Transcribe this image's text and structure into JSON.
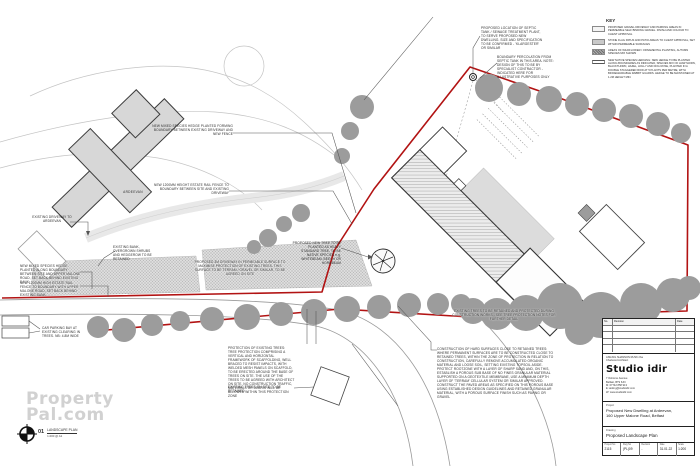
{
  "colors": {
    "boundary_red": "#b21313",
    "tree_gray": "#9c9c9c",
    "building_fill": "#d7d7d7"
  },
  "key": {
    "title": "KEY",
    "items": [
      {
        "icon": "gravel-swatch",
        "label": "PROPOSED GRAVEL DRIVEWAY AND PARKING AREAS IN PERMEABLE SELF BINDING GRAVEL. FINISH AND COLOUR TO CLIENT APPROVAL"
      },
      {
        "icon": "stone-flags-swatch",
        "label": "STONE FLAG PATHS AND PATIO AREAS TO CLIENT APPROVAL, SET WITHIN PERMEABLE SURFACES"
      },
      {
        "icon": "ornamental-planting-swatch",
        "label": "AREAS OF WILDFLOWER / ORNAMENTAL PLANTING, AUTUMN SPECIES MIX SHOWN"
      },
      {
        "icon": "hedge-swatch",
        "label": "NEW NATIVE SPECIES HEDGING: NEW HEDGE TO BE PLANTED ALONG BOUNDARIES AS INDICATED, SPECIES MIX OF HAWTHORN, BLACKTHORN, HAZEL, HOLLY AND DOG ROSE, PLANTED IN A DOUBLE STAGGERED ROW AT 5 PLANTS PER METRE, WITH BIODEGRADABLE RABBIT GUARDS. HEDGE TO BE MAINTAINED AT 1.2M HEIGHT MIN."
      }
    ]
  },
  "annotations": {
    "hedge_driveway": "NEW MIXED SPECIES HEDGE PLANTED FORMING BOUNDARY BETWEEN EXISTING DRIVEWAY AND NEW FENCE",
    "fence_driveway": "NEW 1200MM HEIGHT ESTATE RAIL FENCE TO BOUNDARY BETWEEN SITE AND EXISTING DRIVEWAY",
    "septic_tank": "PROPOSED LOCATION OF SEPTIC TANK / SEWAGE TREATMENT PLANT, TO SERVE PROPOSED NEW DWELLING. SIZE AND SPECIFICATION TO BE CONFIRMED - 'KLARGESTER' OR SIMILAR",
    "percolation": "BOUNDARY PERCOLATION FROM SEPTIC TANK IN THIS AREA. NOTE: DESIGN OF THIS TO BE BY SPECIALIST CONTRACTOR - INDICATED HERE FOR ILLUSTRATIVE PURPOSES ONLY",
    "existing_driveway": "EXISTING DRIVEWAY TO ARDEEVAN",
    "existing_bank": "EXISTING BANK, OVERGROWN SHRUBS AND HEDGEROW TO BE RETAINED",
    "hedge_road": "NEW MIXED SPECIES HEDGE PLANTED ALONG BOUNDARY BETWEEN SITE AND UPPER MALONE ROAD, SET BACK BEHIND EXISTING BANK",
    "fence_road": "NEW 1200MM HIGH ESTATE RAIL FENCE TO BOUNDARY WITH UPPER MALONE ROAD, SET BACK BEHIND EXISTING BANK",
    "car_parking": "CAR PARKING BAY AT EXISTING CLEARING IN TREES. NB: 4.8M WIDE",
    "new_driveway": "PROPOSED 3M DRIVEWAY IN PERMEABLE SURFACE TO MAXIMISE PROTECTION OF EXISTING TREES. THIS SURFACE TO BE TERRAM / GRAVEL OR SIMILAR, TO BE AGREED ON SITE",
    "new_tree": "PROPOSED NEW TREE TO BE PLANTED AS HEAVY STANDARD TREE, TO BE NATIVE SPECIES e.g. WHITEBEAM, BEECH OR HORNBEAM",
    "tree_protection": "PROTECTION OF EXISTING TREES: TREE PROTECTION COMPRISING A VERTICAL AND HORIZONTAL FRAMEWORK OF SCAFFOLDING, WELL BRACED TO RESIST IMPACTS, WITH WELDED MESH PANELS ON SCAFFOLD, TO BE ERECTED AROUND THE BASE OF TREES ON SITE. THE USE OF THE TREES TO BE AGREED WITH ARCHITECT ON SITE. NO CONSTRUCTION TRAFFIC, MATERIALS OR DEBRIS WILL BE ALLOWED WITHIN THIS PROTECTION ZONE",
    "trees_retained": "EXISTING TREES ON SITE TO BE RETAINED",
    "hard_surfaces": "CONSTRUCTION OF HARD SURFACES CLOSE TO RETAINED TREES: WHERE PERMANENT SURFACES ARE TO BE CONSTRUCTED CLOSE TO RETAINED TREES, WITHIN THE ZONE OF PROTECTION IN RELATION TO CONSTRUCTION, CAREFULLY REMOVE ACCUMULATED ORGANIC MATERIAL AND LOOSE SOIL, SETTING EXISTING TOPSOIL ASIDE. PROTECT ROOTZONE WITH A LAYER OF SHARP SAND AND, ON THIS, ESTABLISH A POROUS SUB BASE OF NO FINES GRANULAR MATERIAL SUPPORTED ON A GEOTEXTILE MEMBRANE, USE A MINIMUM DEPTH LAYER OF 'TERRAM' CELLULAR SYSTEM OR SIMILAR APPROVED. CONSTRUCT THE PAVED AREAS AS SPECIFIED ON THIS POROUS BASE USING ESTABLISHED DESIGN GUIDELINES AND RETAINED GRANULAR MATERIAL, WITH A POROUS SURFACE FINISH SUCH AS PAVING OR GRAVEL",
    "trees_boundary": "EXISTING TREES TO BE RETAINED AND PROTECTED DURING CONSTRUCTION WORKS - SEE TREE PROTECTION NOTES FOR FURTHER DETAIL",
    "house_label": "ARDEEVAN"
  },
  "title_block": {
    "revisions": {
      "headers": [
        "No.",
        "Revision",
        "Date"
      ]
    },
    "architect": {
      "pre_lines": [
        "AISLING SHANNON RUSK riba",
        "Chartered Architect"
      ],
      "logo": "Studio idir",
      "address_lines": [
        "7 Osborne Avenue",
        "Belfast, BT9 6JN",
        "M: 07742 858 913",
        "E: aisling@studioidir.com",
        "W: www.studioidir.com"
      ]
    },
    "project": {
      "label": "Project",
      "line1": "Proposed New Dwelling at Ardeevan,",
      "line2": "160 Upper Malone Road, Belfast"
    },
    "drawing": {
      "label": "Drawing",
      "value": "Proposed Landscape Plan"
    },
    "meta": [
      {
        "label": "Project No",
        "value": "2115"
      },
      {
        "label": "Dwg No",
        "value": "(PL)09"
      },
      {
        "label": "Revision",
        "value": "-"
      },
      {
        "label": "Date",
        "value": "31.01.22"
      },
      {
        "label": "Scale",
        "value": "1:200"
      }
    ]
  },
  "scale_note": {
    "number": "01",
    "title": "LANDSCAPE PLAN",
    "scale": "1:200 @ A1"
  },
  "watermark": {
    "line1": "Property",
    "line2": "Pal.com"
  }
}
